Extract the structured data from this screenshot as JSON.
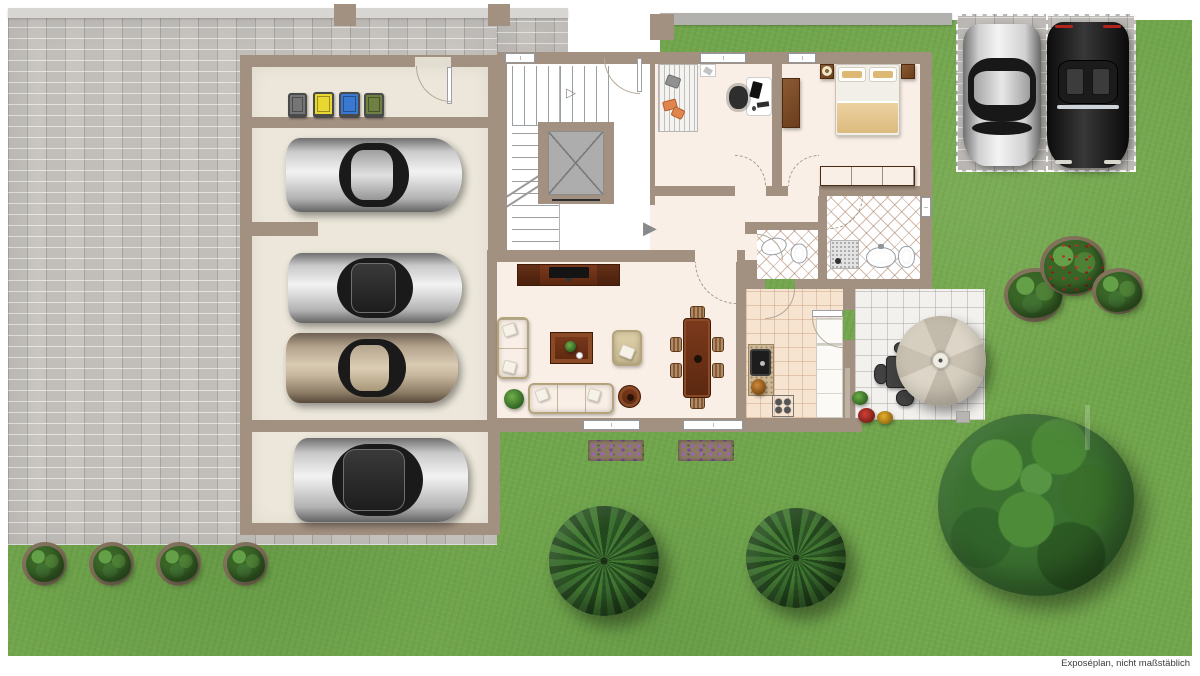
{
  "caption": "Exposéplan, nicht maßstäblich",
  "icons": {
    "entrance_arrow": "▶",
    "stairs_direction_arrow": "▷"
  },
  "palette": {
    "page_bg": "#ffffff",
    "lawn": "#72a64d",
    "paving": "#c8c5c1",
    "fence": "#d8d6d3",
    "wall": "#a29080",
    "garage_floor": "#ece7da",
    "apartment_floor": "#f9efe6",
    "stair_floor": "#ffffff",
    "elevator_cab": "#adadad",
    "kitchen_tile": "#f6e3d0",
    "patio_tile": "#f2f1ee",
    "bed_cushion": "#ddb873",
    "bed_blanket": "#ecd2a0",
    "bin_grey": "#757575",
    "bin_yellow": "#e9d832",
    "bin_blue": "#3b78cf",
    "bin_green": "#6e8142",
    "caption_color": "#3c3c3c"
  },
  "inventory": {
    "recycling_bins": [
      "grey",
      "yellow",
      "blue",
      "green"
    ],
    "garage_vehicles": [
      "silver hatchback",
      "silver sedan",
      "bronze sedan",
      "silver estate"
    ],
    "driveway_vehicles": [
      "silver sedan",
      "black convertible"
    ],
    "rooms": [
      "refuse room",
      "garage",
      "stairwell with elevator",
      "hallway",
      "home office",
      "bedroom",
      "bathroom",
      "guest wc",
      "living room",
      "dining area",
      "kitchen",
      "patio"
    ],
    "garden": [
      "lawn",
      "paved courtyard",
      "parking pad",
      "two conifers",
      "large tree",
      "three shrubs",
      "four hedge balls",
      "two flowerbeds",
      "patio umbrella with seating"
    ]
  }
}
